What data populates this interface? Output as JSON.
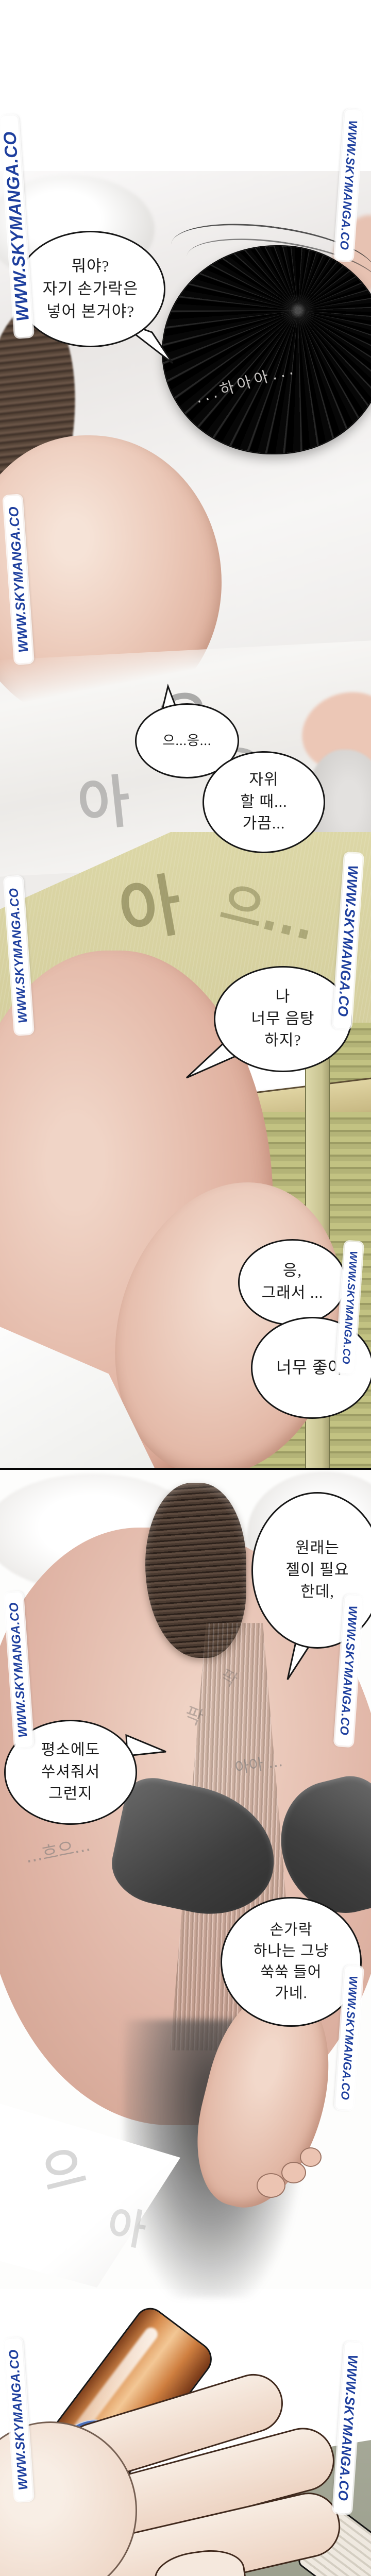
{
  "watermark": {
    "text": "WWW.SKYMANGA.CO",
    "color": "#1e3f9e"
  },
  "bubbles": [
    {
      "text": "뭐야?\n자기 손가락은\n넣어 본거야?"
    },
    {
      "text": "으...응..."
    },
    {
      "text": "자위\n할 때...\n가끔..."
    },
    {
      "text": "나\n너무 음탕\n하지?"
    },
    {
      "text": "응,\n그래서 ..."
    },
    {
      "text": "너무 좋아."
    },
    {
      "text": "원래는\n젤이 필요\n한데,"
    },
    {
      "text": "평소에도\n쑤셔줘서\n그런지"
    },
    {
      "text": "손가락\n하나는 그냥\n쑥쑥 들어\n가네."
    }
  ],
  "sfx": {
    "sigh": "...하아아...",
    "moan_eu": "으",
    "moan_eung": "응",
    "moan_ah": "아",
    "moan_ah_long": "아아 ...",
    "moan_heu": "...흐으...",
    "moan_eu_dots": "으...",
    "thrust": "팍"
  },
  "palette": {
    "watermark_blue": "#1e3f9e",
    "floor_khaki": "#d6d1a0",
    "shutter_green": "#a9a96e",
    "skin_pink": "#e2b5a4",
    "label_blue": "#3a5fae",
    "bottle_orange": "#d98e4f",
    "bg_green_gray": "#a9ac9b"
  }
}
